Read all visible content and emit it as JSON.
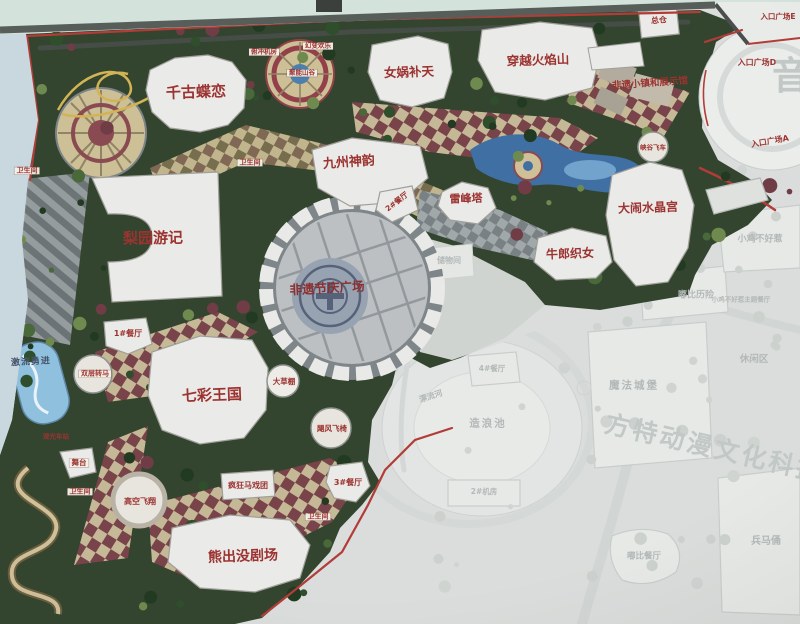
{
  "watermarks": {
    "yin": "音",
    "fantawild_park": "方特动漫文化科技园"
  },
  "attractions": {
    "qiangu_dielian": "千古蝶恋",
    "nvwa_butian": "女娲补天",
    "chuanyue_huoyanshan": "穿越火焰山",
    "jiuzhou_shenyun": "九州神韵",
    "liyuan_youji": "梨园游记",
    "feiyi_jieqing_guangchang": "非遗节庆广场",
    "leifengta": "雷峰塔",
    "niulang_zhinv": "牛郎织女",
    "danao_shuijinggong": "大闹水晶宫",
    "qicai_wangguo": "七彩王国",
    "xiongchumo_juchang": "熊出没剧场",
    "fengkuang_maxituan": "疯狂马戏团",
    "gaokong_feixiang": "高空飞翔",
    "jufeng_feiyi": "飓风飞椅",
    "shuangceng_zhuanma": "双层转马",
    "jiliu_yongjin": "激流勇进",
    "dacaopeng": "大草棚",
    "wutai": "舞台",
    "xiagu_feiche": "峡谷飞车",
    "fuchong_jifang": "俯冲机房",
    "huanbian_huanle": "幻变欢乐",
    "juneng_shangu": "聚能山谷",
    "feiyi_xiaozhen": "非遗小镇和展示馆"
  },
  "facilities": {
    "restaurant_1": "1#餐厅",
    "restaurant_2": "2#餐厅",
    "restaurant_3": "3#餐厅",
    "restaurant_4": "4#餐厅",
    "restroom_a": "卫生间",
    "restroom_b": "卫生间",
    "restroom_c": "卫生间",
    "restroom_d": "卫生间",
    "zongcang": "总仓",
    "guanguang_chezhan": "观光车站",
    "machine_room_2": "2#机房",
    "chuwujian": "储物间"
  },
  "entrances": {
    "d": "入口广场D",
    "e": "入口广场E",
    "a": "入口广场A"
  },
  "phase2": {
    "mofa_chengbao": "魔法城堡",
    "xiuxianqu": "休闲区",
    "dubi_lixian": "嘟比历险",
    "xiaoji_buhaore": "小鸡不好惹",
    "xiaoji_restaurant": "小鸡不好惹主题餐厅",
    "zaolangchi": "造浪池",
    "piaoliuhe": "漂流河",
    "dubi_canting": "嘟比餐厅",
    "bingmayong": "兵马俑"
  }
}
